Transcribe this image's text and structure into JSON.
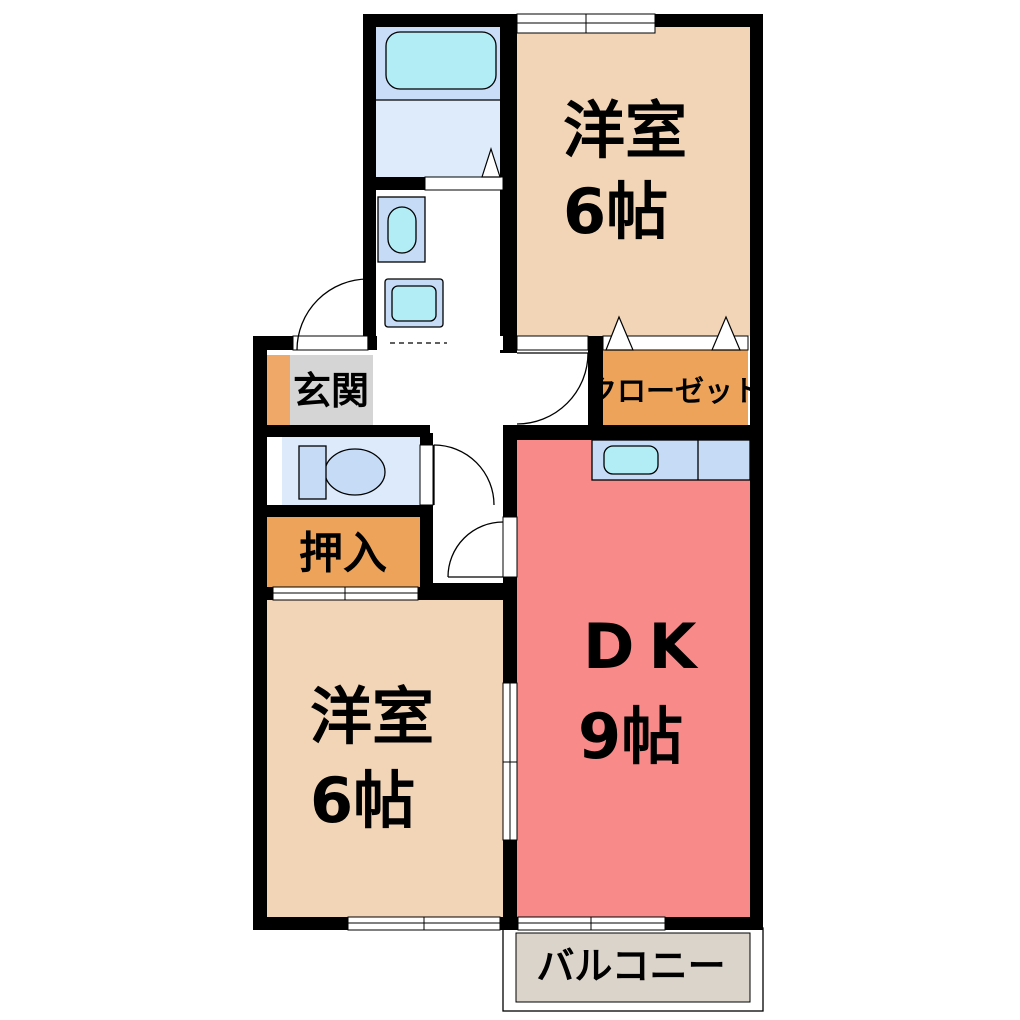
{
  "plan": {
    "type": "japanese-apartment-floorplan",
    "rooms": {
      "bedroom_top": {
        "label": "洋室",
        "size": "6帖"
      },
      "bedroom_bottom": {
        "label": "洋室",
        "size": "6帖"
      },
      "dining_kitchen": {
        "label": "DK",
        "size": "9帖"
      },
      "entrance": {
        "label": "玄関"
      },
      "closet": {
        "label": "クローゼット"
      },
      "oshiire": {
        "label": "押入"
      },
      "balcony": {
        "label": "バルコニー"
      }
    },
    "fixtures": [
      "bathtub",
      "washbasin",
      "washing-machine",
      "toilet",
      "kitchen-sink"
    ],
    "colors": {
      "wall": "#000000",
      "room_beige": "#F2D4B6",
      "dk_pink": "#F98A8A",
      "closet_orange": "#EDA45A",
      "entry_step_orange": "#F0A869",
      "entry_gray": "#D5D5D5",
      "toilet_blue": "#DCEAFB",
      "bath_zone_blue": "#C9DDF8",
      "bath_floor_blue": "#DDEBFB",
      "fixture_blue": "#C5DBF6",
      "fixture_cyan": "#B2EDF5",
      "balcony_gray": "#DBD4CB",
      "line": "#000000"
    }
  }
}
